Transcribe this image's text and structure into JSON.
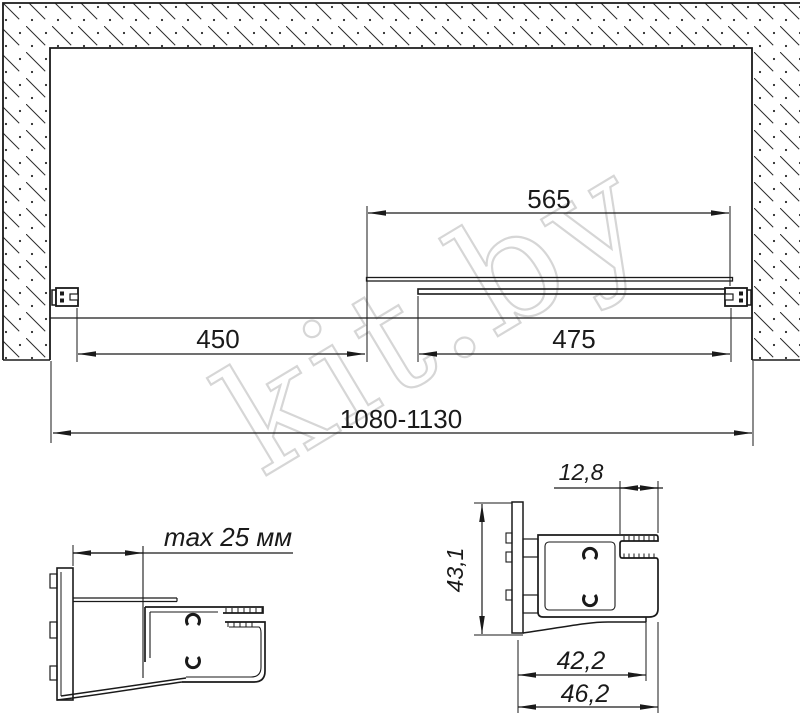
{
  "main_view": {
    "panel_width": "565",
    "opening_width": "450",
    "door_width": "475",
    "total_width": "1080-1130"
  },
  "detail_left": {
    "adjustment": "max 25 мм"
  },
  "detail_right": {
    "slot_depth": "12,8",
    "profile_height": "43,1",
    "inner_width": "42,2",
    "outer_width": "46,2"
  },
  "watermark": {
    "text": "kit.by",
    "color": "#d6d6d6"
  },
  "colors": {
    "line": "#1a1a1a",
    "background": "#ffffff"
  }
}
